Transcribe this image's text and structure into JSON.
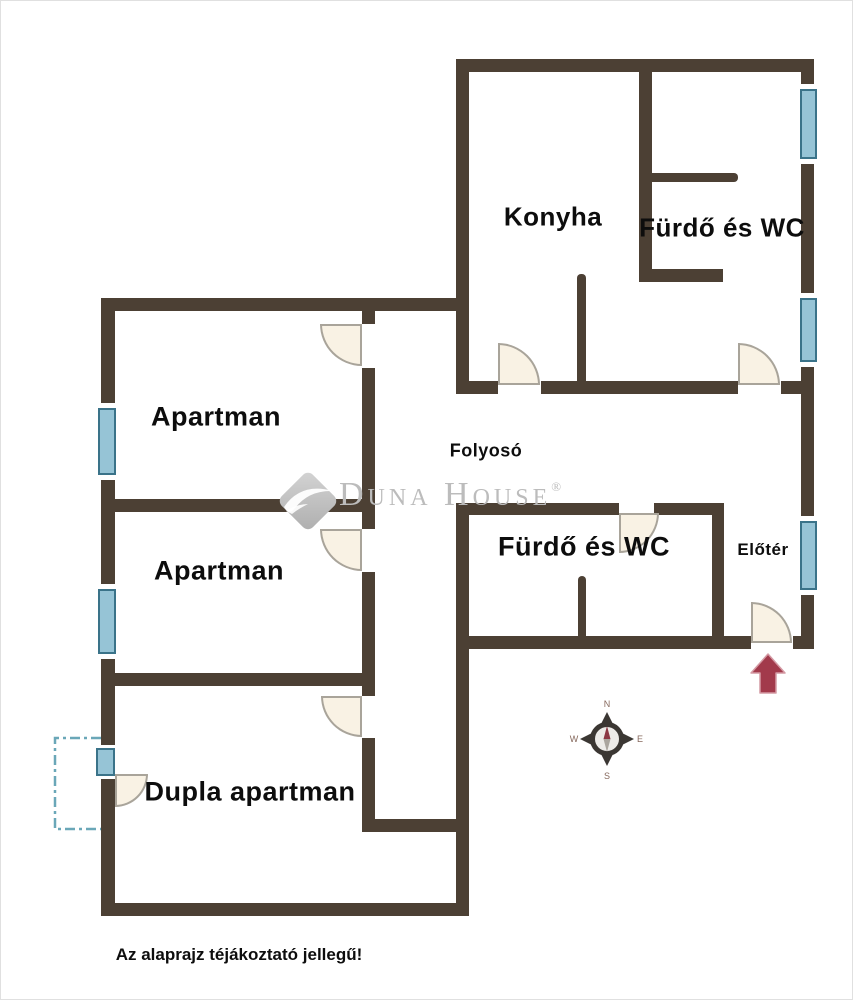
{
  "rooms": {
    "konyha": "Konyha",
    "furdo_wc_top": "Fürdő és WC",
    "apartman_1": "Apartman",
    "apartman_2": "Apartman",
    "folyoso": "Folyosó",
    "furdo_wc_bottom": "Fürdő és WC",
    "eloter": "Előtér",
    "dupla_apartman": "Dupla apartman"
  },
  "watermark": {
    "brand": "Duna House",
    "registered": "®"
  },
  "compass": {
    "north": "N",
    "east": "E",
    "south": "S",
    "west": "W"
  },
  "disclaimer": "Az alaprajz téjákoztató jellegű!",
  "colors": {
    "wall": "#4c4034",
    "window_fill": "#96c4d6",
    "window_border": "#3a7389",
    "door_fill": "#f9f2e4",
    "door_border": "#a9a49a",
    "arrow": "#a23a4b",
    "arrow_outline": "#d49aa4",
    "compass_ring": "#3b3733",
    "compass_face": "#edebe8",
    "needle_north": "#8c3844",
    "needle_south": "#aaa59e",
    "watermark": "#bcbcbc",
    "balcony_dash": "#6aa7b8",
    "text": "#0d0d0d",
    "bg": "#ffffff"
  }
}
